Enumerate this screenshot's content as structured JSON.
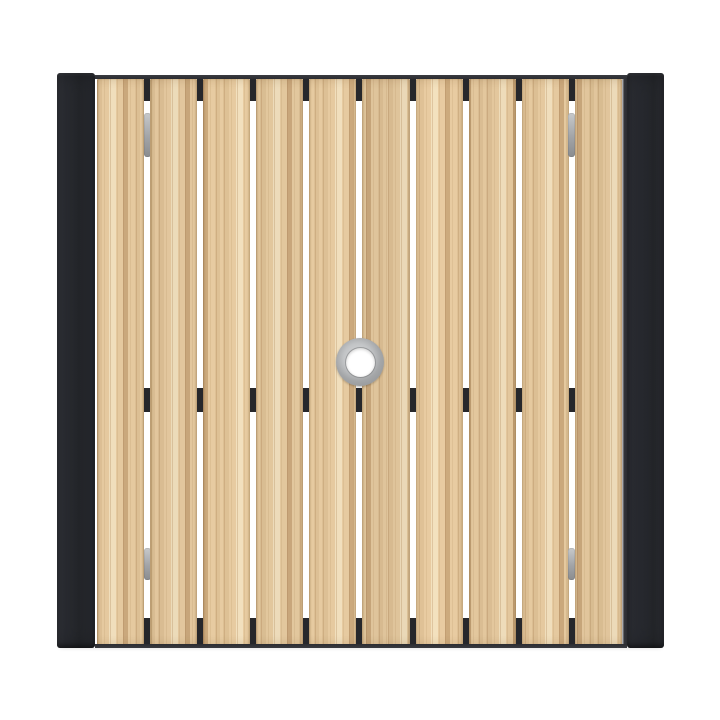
{
  "scene": {
    "description": "Top-down product photo of a square outdoor patio table with ten vertical light wood-look slats, black metal end rails on the left and right edges, a black frame visible through the slat gaps at the top, middle and bottom, gray spring clips in the first and last gaps, and a round stainless umbrella hole at the center",
    "background_color": "#ffffff"
  },
  "structure": {
    "slat_count": 10,
    "gap_count": 9,
    "clip_gap_indices": [
      0,
      8
    ],
    "crossbar_visible_through_gaps": true,
    "umbrella_hole": {
      "present": true,
      "position": "center",
      "outer_diameter_px": 48,
      "inner_diameter_px": 29
    }
  },
  "palette": {
    "background": "#ffffff",
    "frame_black": "#26282e",
    "notch_black": "#26272b",
    "wood_base": "#e5c99f",
    "wood_light": "#f0debc",
    "wood_mid": "#dcbf94",
    "wood_dark": "#caa87c",
    "clip_gray": "#a9abae",
    "ring_gray": "#a4a6a8",
    "ring_edge": "#7f8183",
    "hole_white": "#ffffff"
  },
  "slat_grain": {
    "offsets_px": [
      0,
      9,
      21,
      5,
      14,
      26,
      3,
      18,
      11,
      23
    ],
    "brightness": [
      1.0,
      0.985,
      1.01,
      0.988,
      1.005,
      0.975,
      1.012,
      0.99,
      1.0,
      0.982
    ]
  }
}
